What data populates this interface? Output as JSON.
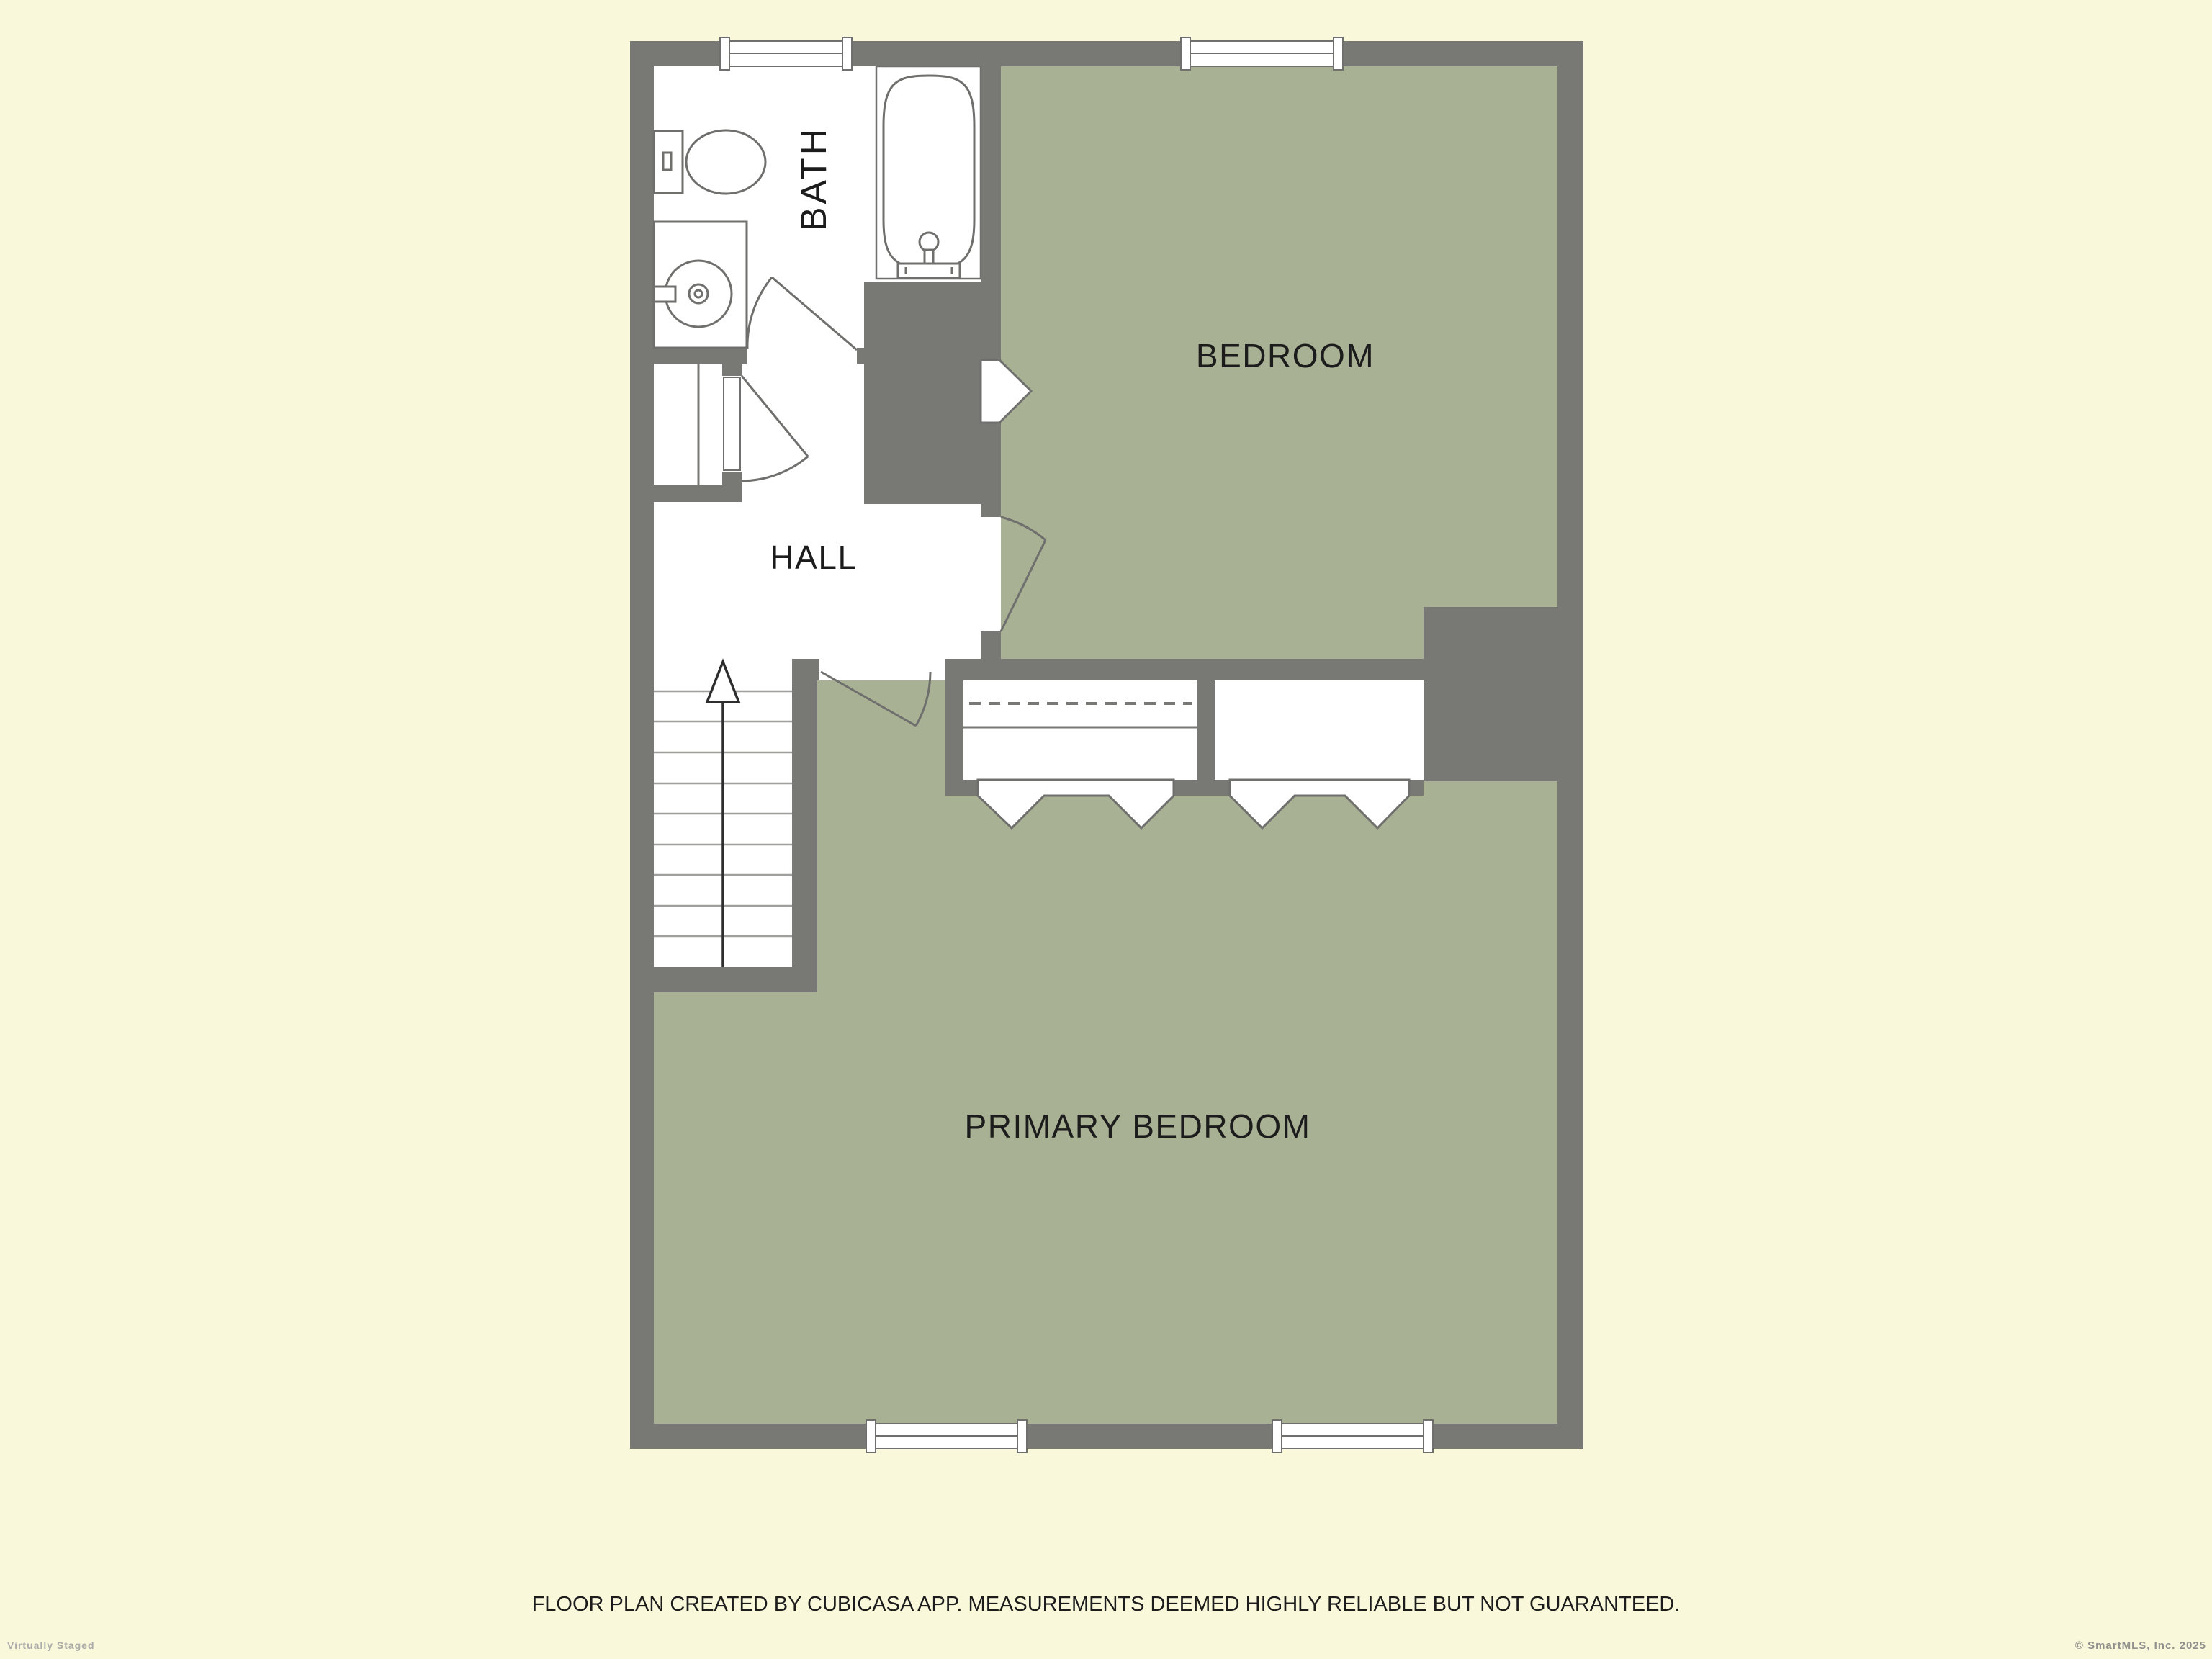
{
  "colors": {
    "background": "#faf8da",
    "wall_gray": "#787875",
    "room_green": "#a8b194",
    "room_white": "#ffffff",
    "outline_gray": "#6f6f6d",
    "label_text": "#1c1c1c",
    "watermark_gray": "#ababa9"
  },
  "rooms": {
    "bath": {
      "label": "BATH"
    },
    "bedroom": {
      "label": "BEDROOM"
    },
    "hall": {
      "label": "HALL"
    },
    "primary_bedroom": {
      "label": "PRIMARY BEDROOM"
    }
  },
  "fixtures": [
    "toilet",
    "sink-vanity",
    "bathtub",
    "staircase-up",
    "closet-hanging-rail",
    "closet-left",
    "closet-right"
  ],
  "footer": {
    "disclaimer": "FLOOR PLAN CREATED BY CUBICASA APP. MEASUREMENTS DEEMED HIGHLY RELIABLE BUT NOT GUARANTEED."
  },
  "watermarks": {
    "bottom_left": "Virtually Staged",
    "bottom_right": "© SmartMLS, Inc.  2025"
  }
}
